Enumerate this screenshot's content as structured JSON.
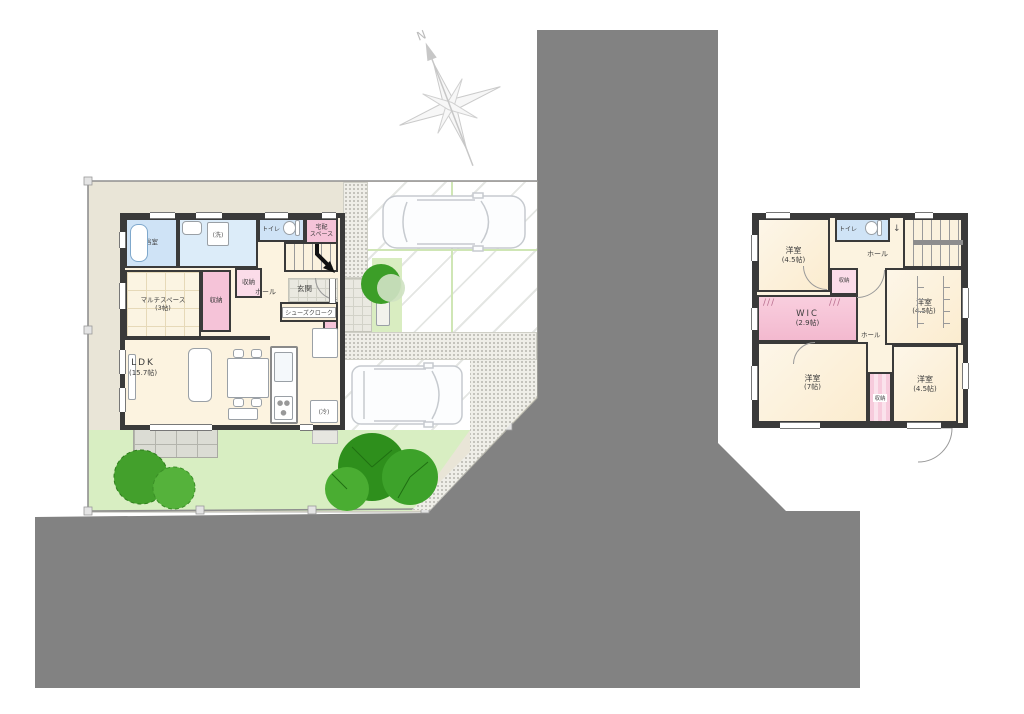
{
  "compass": {
    "north_label": "N"
  },
  "colors": {
    "road": "#828282",
    "lot": "#e9e5d7",
    "lawn": "#d8eec2",
    "tree_green": "#3da22a",
    "house_floor": "#fcf3e0",
    "wet_room_blue": "#cfe3f6",
    "storage_pink": "#f5c3d8",
    "wall": "#3a3a3a"
  },
  "floor1": {
    "rooms": {
      "bath": {
        "name": "浴室"
      },
      "washroom": {
        "name": "洗面所"
      },
      "washer": {
        "name": "(洗)"
      },
      "toilet": {
        "name": "トイレ"
      },
      "delivery": {
        "line1": "宅配",
        "line2": "スペース"
      },
      "multi": {
        "name": "マルチスペース",
        "size": "(3帖)"
      },
      "storage_a": {
        "name": "収納"
      },
      "storage_b": {
        "name": "収納"
      },
      "storage_c": {
        "name": "収納"
      },
      "hall": {
        "name": "ホール"
      },
      "entrance": {
        "name": "玄関"
      },
      "shoe_closet": {
        "name": "シューズクローク"
      },
      "ldk": {
        "name": "LDK",
        "size": "(15.7帖)"
      },
      "fridge": {
        "name": "(冷)"
      }
    }
  },
  "floor2": {
    "rooms": {
      "bedroom_nw": {
        "name": "洋室",
        "size": "(4.5帖)"
      },
      "toilet": {
        "name": "トイレ"
      },
      "hall_upper": {
        "name": "ホール"
      },
      "storage_a": {
        "name": "収納"
      },
      "wic": {
        "name": "WIC",
        "size": "(2.9帖)"
      },
      "bedroom_e": {
        "name": "洋室",
        "size": "(4.5帖)"
      },
      "hall_lower": {
        "name": "ホール"
      },
      "bedroom_sw": {
        "name": "洋室",
        "size": "(7帖)"
      },
      "storage_b": {
        "name": "収納"
      },
      "bedroom_se": {
        "name": "洋室",
        "size": "(4.5帖)"
      }
    }
  }
}
